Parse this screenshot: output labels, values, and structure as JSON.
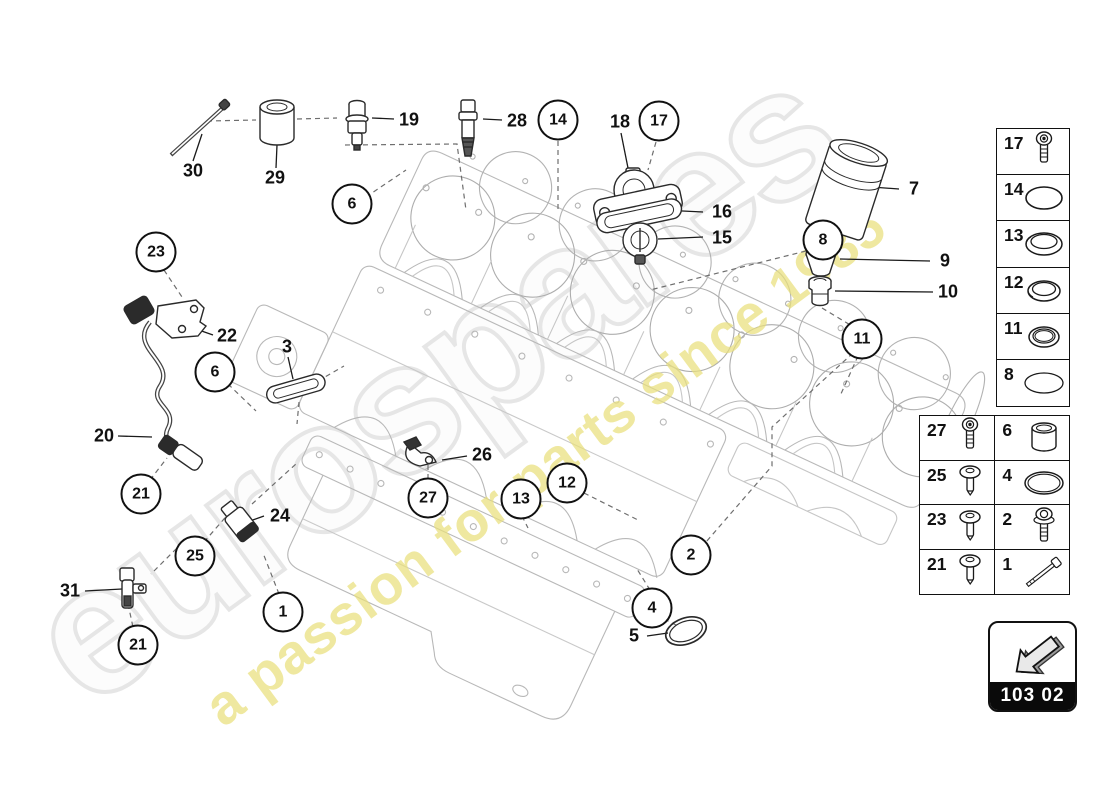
{
  "watermark": {
    "brand": "eurospares",
    "tagline": "a passion for parts since 1985",
    "brand_color": "#e6e6e6",
    "tagline_color": "#e9e07c"
  },
  "page_code": {
    "label": "103 02"
  },
  "diagram": {
    "description": "oil sump / engine block exploded parts diagram",
    "callouts": [
      {
        "label": "30",
        "x": 193,
        "y": 171,
        "circled": false
      },
      {
        "label": "29",
        "x": 275,
        "y": 178,
        "circled": false
      },
      {
        "label": "19",
        "x": 409,
        "y": 120,
        "circled": false
      },
      {
        "label": "28",
        "x": 517,
        "y": 121,
        "circled": false
      },
      {
        "label": "14",
        "x": 558,
        "y": 120,
        "circled": true
      },
      {
        "label": "18",
        "x": 620,
        "y": 122,
        "circled": false
      },
      {
        "label": "17",
        "x": 659,
        "y": 121,
        "circled": true
      },
      {
        "label": "6",
        "x": 352,
        "y": 204,
        "circled": true
      },
      {
        "label": "16",
        "x": 722,
        "y": 212,
        "circled": false
      },
      {
        "label": "15",
        "x": 722,
        "y": 238,
        "circled": false
      },
      {
        "label": "7",
        "x": 914,
        "y": 189,
        "circled": false
      },
      {
        "label": "8",
        "x": 823,
        "y": 240,
        "circled": true
      },
      {
        "label": "9",
        "x": 945,
        "y": 261,
        "circled": false
      },
      {
        "label": "10",
        "x": 948,
        "y": 292,
        "circled": false
      },
      {
        "label": "11",
        "x": 862,
        "y": 339,
        "circled": true
      },
      {
        "label": "23",
        "x": 156,
        "y": 252,
        "circled": true
      },
      {
        "label": "22",
        "x": 227,
        "y": 336,
        "circled": false
      },
      {
        "label": "3",
        "x": 287,
        "y": 347,
        "circled": false
      },
      {
        "label": "6",
        "x": 215,
        "y": 372,
        "circled": true
      },
      {
        "label": "20",
        "x": 104,
        "y": 436,
        "circled": false
      },
      {
        "label": "21",
        "x": 141,
        "y": 494,
        "circled": true
      },
      {
        "label": "24",
        "x": 280,
        "y": 516,
        "circled": false
      },
      {
        "label": "26",
        "x": 482,
        "y": 455,
        "circled": false
      },
      {
        "label": "27",
        "x": 428,
        "y": 498,
        "circled": true
      },
      {
        "label": "13",
        "x": 521,
        "y": 499,
        "circled": true
      },
      {
        "label": "12",
        "x": 567,
        "y": 483,
        "circled": true
      },
      {
        "label": "25",
        "x": 195,
        "y": 556,
        "circled": true
      },
      {
        "label": "2",
        "x": 691,
        "y": 555,
        "circled": true
      },
      {
        "label": "31",
        "x": 70,
        "y": 591,
        "circled": false
      },
      {
        "label": "1",
        "x": 283,
        "y": 612,
        "circled": true
      },
      {
        "label": "4",
        "x": 652,
        "y": 608,
        "circled": true
      },
      {
        "label": "5",
        "x": 634,
        "y": 636,
        "circled": false
      },
      {
        "label": "21",
        "x": 138,
        "y": 645,
        "circled": true
      }
    ]
  },
  "legend": {
    "single_rows": [
      {
        "num": "17",
        "icon": "torx-bolt"
      },
      {
        "num": "14",
        "icon": "o-ring"
      },
      {
        "num": "13",
        "icon": "seal-ring"
      },
      {
        "num": "12",
        "icon": "seal-ring"
      },
      {
        "num": "11",
        "icon": "seal-ring"
      },
      {
        "num": "8",
        "icon": "o-ring"
      }
    ],
    "double_rows": [
      {
        "left": {
          "num": "27",
          "icon": "torx-bolt"
        },
        "right": {
          "num": "6",
          "icon": "sleeve"
        }
      },
      {
        "left": {
          "num": "25",
          "icon": "pan-screw"
        },
        "right": {
          "num": "4",
          "icon": "o-ring"
        }
      },
      {
        "left": {
          "num": "23",
          "icon": "pan-screw"
        },
        "right": {
          "num": "2",
          "icon": "flange-bolt"
        }
      },
      {
        "left": {
          "num": "21",
          "icon": "pan-screw"
        },
        "right": {
          "num": "1",
          "icon": "long-bolt"
        }
      }
    ]
  }
}
